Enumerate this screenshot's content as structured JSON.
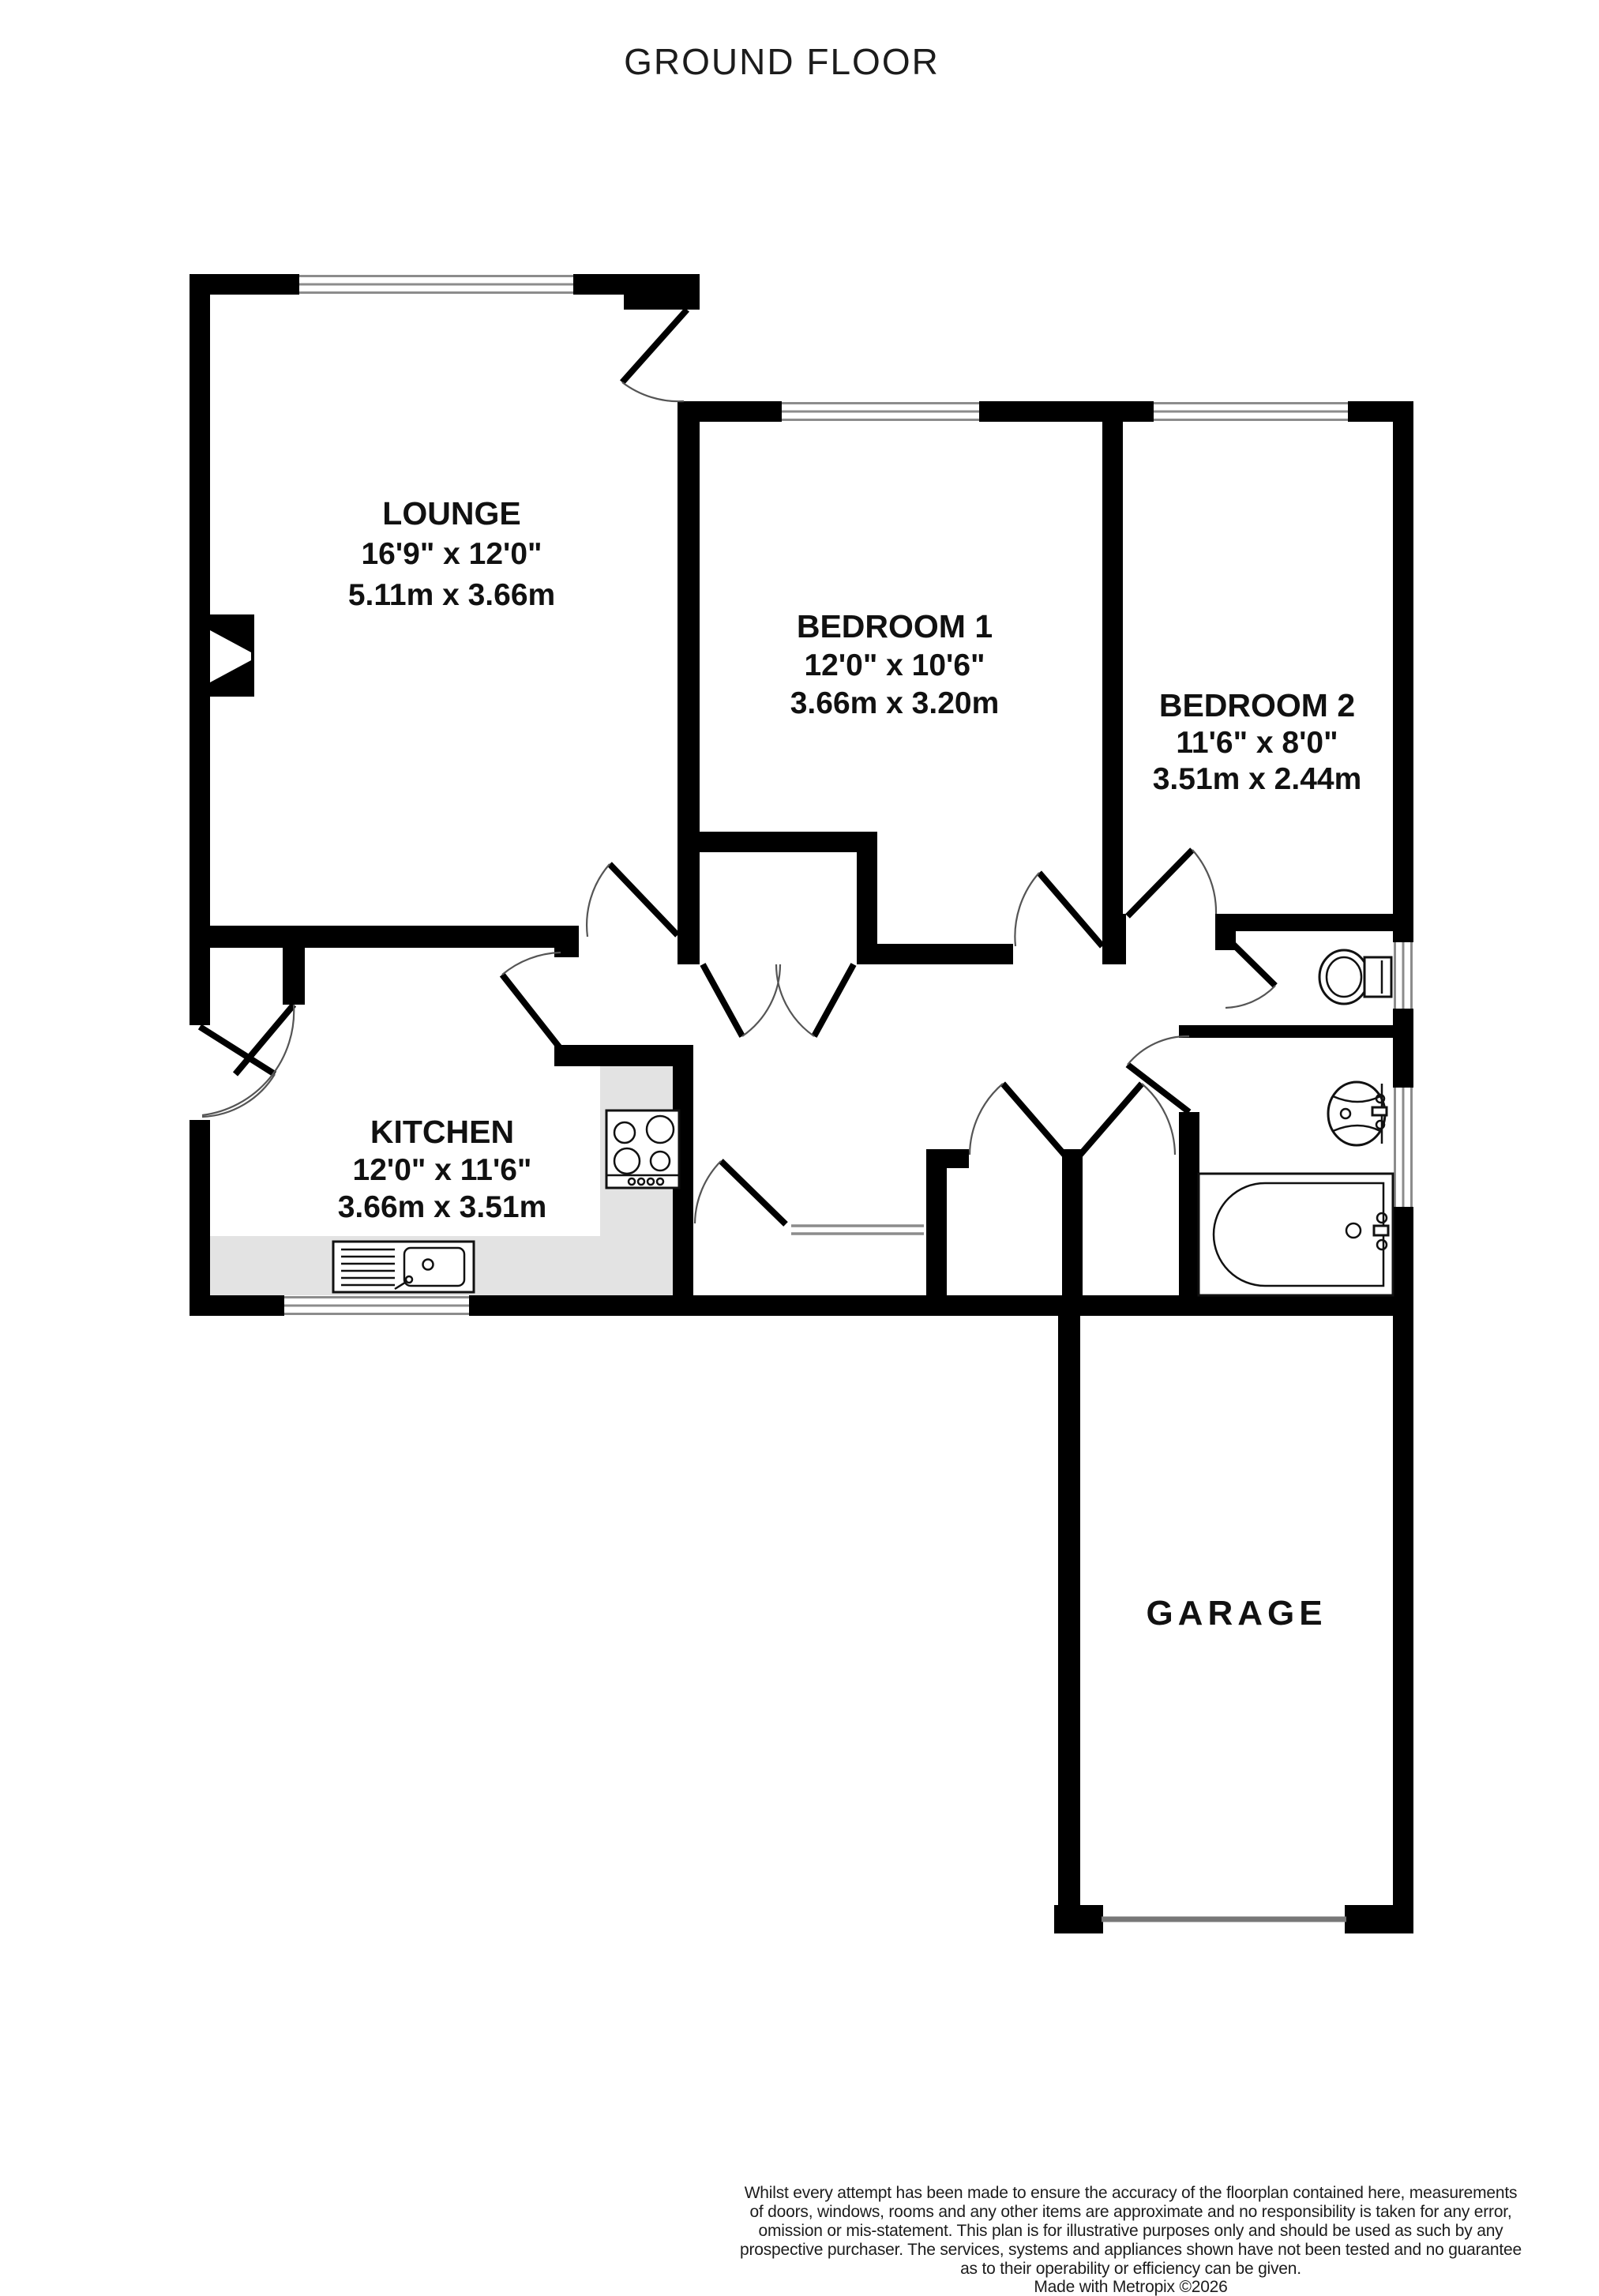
{
  "title": "GROUND FLOOR",
  "rooms": [
    {
      "name": "LOUNGE",
      "dims_imperial": "16'9\" x 12'0\"",
      "dims_metric": "5.11m x 3.66m"
    },
    {
      "name": "BEDROOM 1",
      "dims_imperial": "12'0\" x 10'6\"",
      "dims_metric": "3.66m x 3.20m"
    },
    {
      "name": "BEDROOM 2",
      "dims_imperial": "11'6\" x 8'0\"",
      "dims_metric": "3.51m x 2.44m"
    },
    {
      "name": "KITCHEN",
      "dims_imperial": "12'0\" x 11'6\"",
      "dims_metric": "3.66m x 3.51m"
    },
    {
      "name": "GARAGE"
    }
  ],
  "fixtures": [
    "fireplace",
    "kitchen-counter",
    "hob",
    "sink-drainer",
    "toilet",
    "basin",
    "bathtub",
    "garage-door",
    "windows",
    "door-swings"
  ],
  "colors": {
    "wall": "#000000",
    "background": "#ffffff",
    "counter": "#e3e3e3",
    "window_line": "#8c8c8c",
    "garage_door_line": "#777777"
  },
  "footer": {
    "lines": [
      "Whilst every attempt has been made to ensure the accuracy of the floorplan contained here, measurements",
      "of doors, windows, rooms and any other items are approximate and no responsibility is taken for any error,",
      "omission or mis-statement. This plan is for illustrative purposes only and should be used as such by any",
      "prospective purchaser. The services, systems and appliances shown have not been tested and no guarantee",
      "as to their operability or efficiency can be given."
    ],
    "made_with": "Made with Metropix ©2026"
  }
}
